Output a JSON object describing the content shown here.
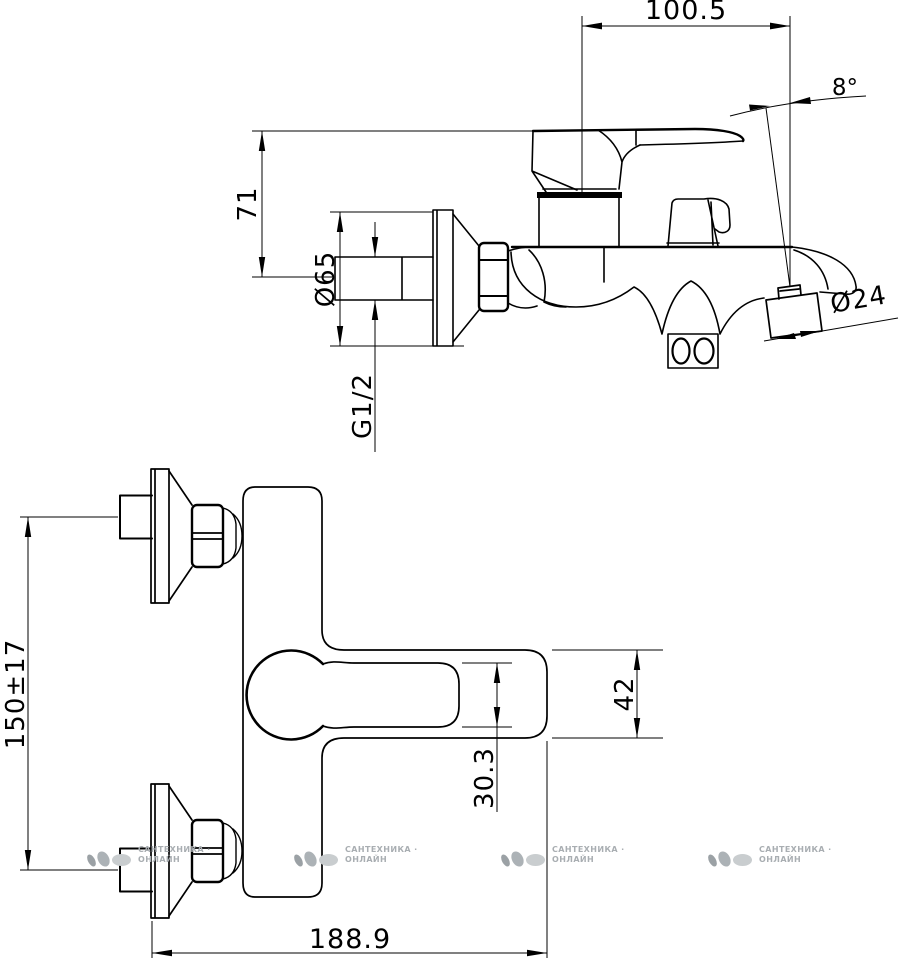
{
  "side_view": {
    "dims": {
      "width_top": "100.5",
      "spout_angle": "8°",
      "height_to_handle": "71",
      "flange_diameter": "Ø65",
      "connection_thread": "G1/2",
      "aerator_diameter": "Ø24"
    }
  },
  "front_view": {
    "dims": {
      "inlet_spacing": "150±17",
      "handle_thickness": "30.3",
      "body_height": "42",
      "overall_width": "188.9"
    }
  },
  "watermark": {
    "line1": "САНТЕХНИКА ·",
    "line2": "ОНЛАЙН"
  }
}
